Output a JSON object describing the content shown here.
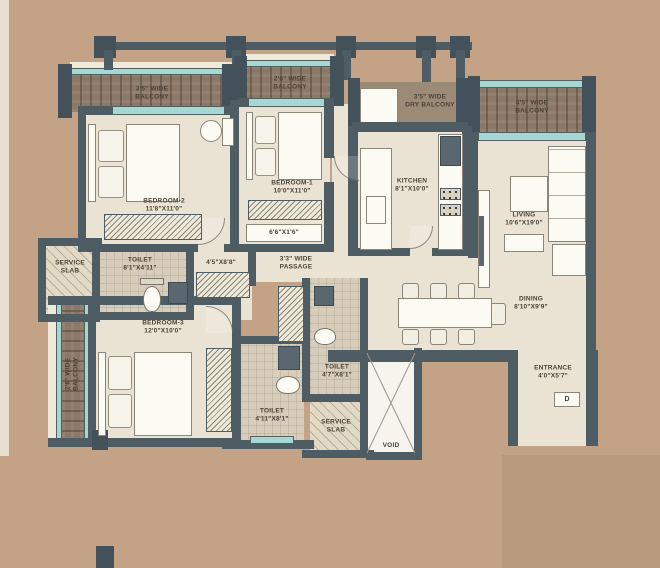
{
  "colors": {
    "background": "#c3a285",
    "wall": "#4e5c63",
    "floor": "#eae3d3",
    "toilet_floor": "#d8cdbb",
    "balcony_wood": "#8b7866",
    "window_teal": "#a5d8d2",
    "furniture": "#fbfaf3",
    "text": "#4b4338"
  },
  "rooms": {
    "balcony_top_left": {
      "line1": "3'5\" WIDE",
      "line2": "BALCONY"
    },
    "balcony_top_mid": {
      "line1": "2'6\" WIDE",
      "line2": "BALCONY"
    },
    "dry_balcony": {
      "line1": "3'5\" WIDE",
      "line2": "DRY BALCONY"
    },
    "balcony_right": {
      "line1": "4'5\" WIDE",
      "line2": "BALCONY"
    },
    "balcony_left": {
      "line1": "2'6\" WIDE",
      "line2": "BALCONY"
    },
    "bedroom1": {
      "name": "BEDROOM-1",
      "dims": "10'0\"X11'0\""
    },
    "bedroom2": {
      "name": "BEDROOM-2",
      "dims": "11'8\"X11'0\""
    },
    "bedroom3": {
      "name": "BEDROOM-3",
      "dims": "12'0\"X10'0\""
    },
    "kitchen": {
      "name": "KITCHEN",
      "dims": "8'1\"X10'0\""
    },
    "living": {
      "name": "LIVING",
      "dims": "10'6\"X19'0\""
    },
    "dining": {
      "name": "DINING",
      "dims": "8'10\"X9'9\""
    },
    "passage": {
      "line1": "3'3\" WIDE",
      "line2": "PASSAGE"
    },
    "toilet_top": {
      "name": "TOILET",
      "dims": "8'1\"X4'11\""
    },
    "toilet_mid": {
      "name": "TOILET",
      "dims": "4'7\"X8'1\""
    },
    "toilet_bottom": {
      "name": "TOILET",
      "dims": "4'11\"X8'1\""
    },
    "service_slab_left": {
      "line1": "SERVICE",
      "line2": "SLAB"
    },
    "service_slab_bottom": {
      "line1": "SERVICE",
      "line2": "SLAB"
    },
    "entrance": {
      "name": "ENTRANCE",
      "dims": "4'0\"X5'7\""
    },
    "void": {
      "name": "VOID"
    },
    "niche_dim": "6'6\"X1'6\"",
    "dressing_dim": "4'5\"X8'8\"",
    "door_tag": "D"
  }
}
